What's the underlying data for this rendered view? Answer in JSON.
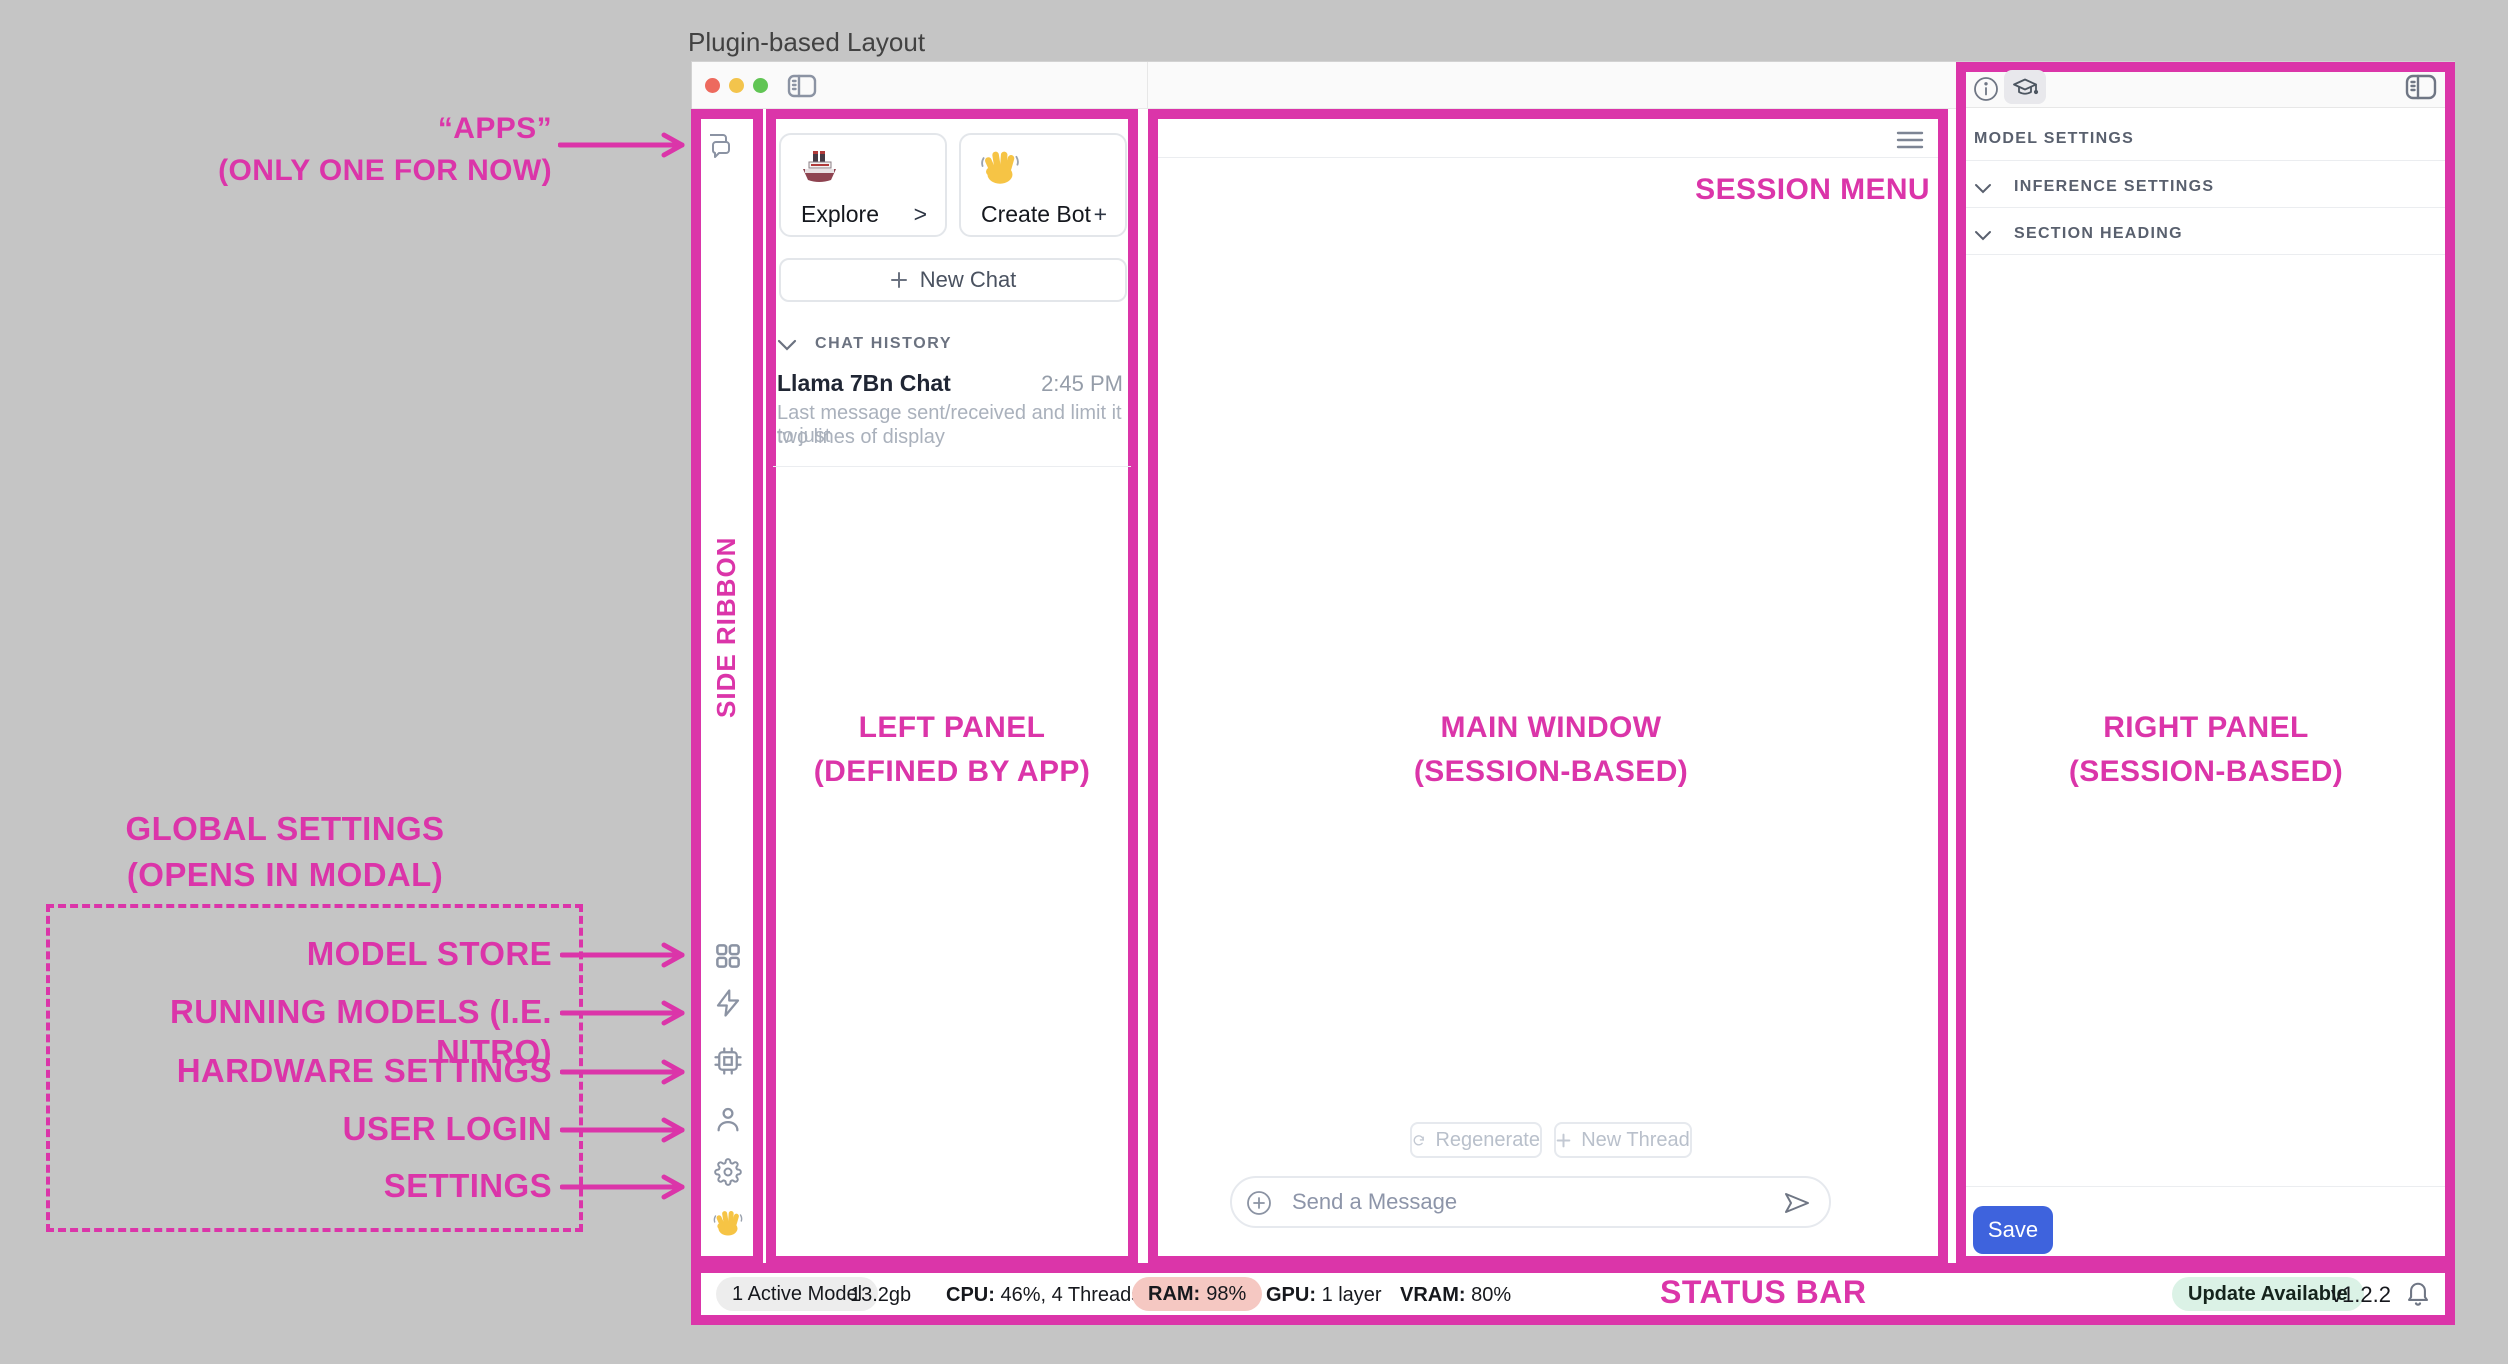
{
  "page_title": "Plugin-based Layout",
  "colors": {
    "pink": "#DB35A9",
    "save_blue": "#3E63DD",
    "ram_badge_bg": "#F5C8C2",
    "update_badge_bg": "#DBF2E6",
    "traffic_red": "#ED6A5E",
    "traffic_yellow": "#F3C44C",
    "traffic_green": "#61C554"
  },
  "annotations": {
    "apps": {
      "line1": "“APPS”",
      "line2": "(ONLY ONE FOR NOW)"
    },
    "side_ribbon": "SIDE RIBBON",
    "left_panel": {
      "line1": "LEFT PANEL",
      "line2": "(DEFINED BY APP)"
    },
    "main_window": {
      "line1": "MAIN WINDOW",
      "line2": "(SESSION-BASED)"
    },
    "right_panel": {
      "line1": "RIGHT PANEL",
      "line2": "(SESSION-BASED)"
    },
    "session_menu": "SESSION MENU",
    "status_bar": "STATUS BAR",
    "global_settings": {
      "line1": "GLOBAL SETTINGS",
      "line2": "(OPENS IN MODAL)"
    },
    "ribbon_labels": [
      "MODEL STORE",
      "RUNNING MODELS (I.E. NITRO)",
      "HARDWARE SETTINGS",
      "USER LOGIN",
      "SETTINGS"
    ]
  },
  "left_panel": {
    "cards": [
      {
        "label": "Explore",
        "action": ">",
        "icon": "ship-icon"
      },
      {
        "label": "Create Bot",
        "action": "+",
        "icon": "waving-hand-icon"
      }
    ],
    "new_chat_label": "New Chat",
    "chat_history_header": "CHAT HISTORY",
    "chats": [
      {
        "title": "Llama 7Bn Chat",
        "time": "2:45 PM",
        "preview_line1": "Last message sent/received and limit it to just",
        "preview_line2": "two lines of display"
      }
    ]
  },
  "main": {
    "regenerate_label": "Regenerate",
    "new_thread_label": "New Thread",
    "composer_placeholder": "Send a Message"
  },
  "right_panel": {
    "header": "MODEL SETTINGS",
    "sections": [
      "INFERENCE SETTINGS",
      "SECTION HEADING"
    ],
    "save_label": "Save"
  },
  "status_bar": {
    "active_model": "1 Active Model",
    "memory_size": "13.2gb",
    "cpu_label": "CPU:",
    "cpu_value": "46%, 4 Threads",
    "ram_label": "RAM:",
    "ram_value": "98%",
    "gpu_label": "GPU:",
    "gpu_value": "1 layer",
    "vram_label": "VRAM:",
    "vram_value": "80%",
    "update_badge": "Update Available",
    "version": "v1.2.2"
  },
  "icons": {
    "side_ribbon_top": [
      "chat-bubbles-icon"
    ],
    "side_ribbon_bottom": [
      "grid-icon",
      "lightning-icon",
      "chip-icon",
      "person-icon",
      "gear-icon",
      "waving-hand-icon"
    ],
    "titlebar": [
      "close-button",
      "minimize-button",
      "zoom-button",
      "sidebar-toggle-icon"
    ],
    "right_panel_header": [
      "info-icon",
      "graduation-cap-icon",
      "sidebar-toggle-icon"
    ],
    "statusbar_right": [
      "bell-icon"
    ]
  }
}
